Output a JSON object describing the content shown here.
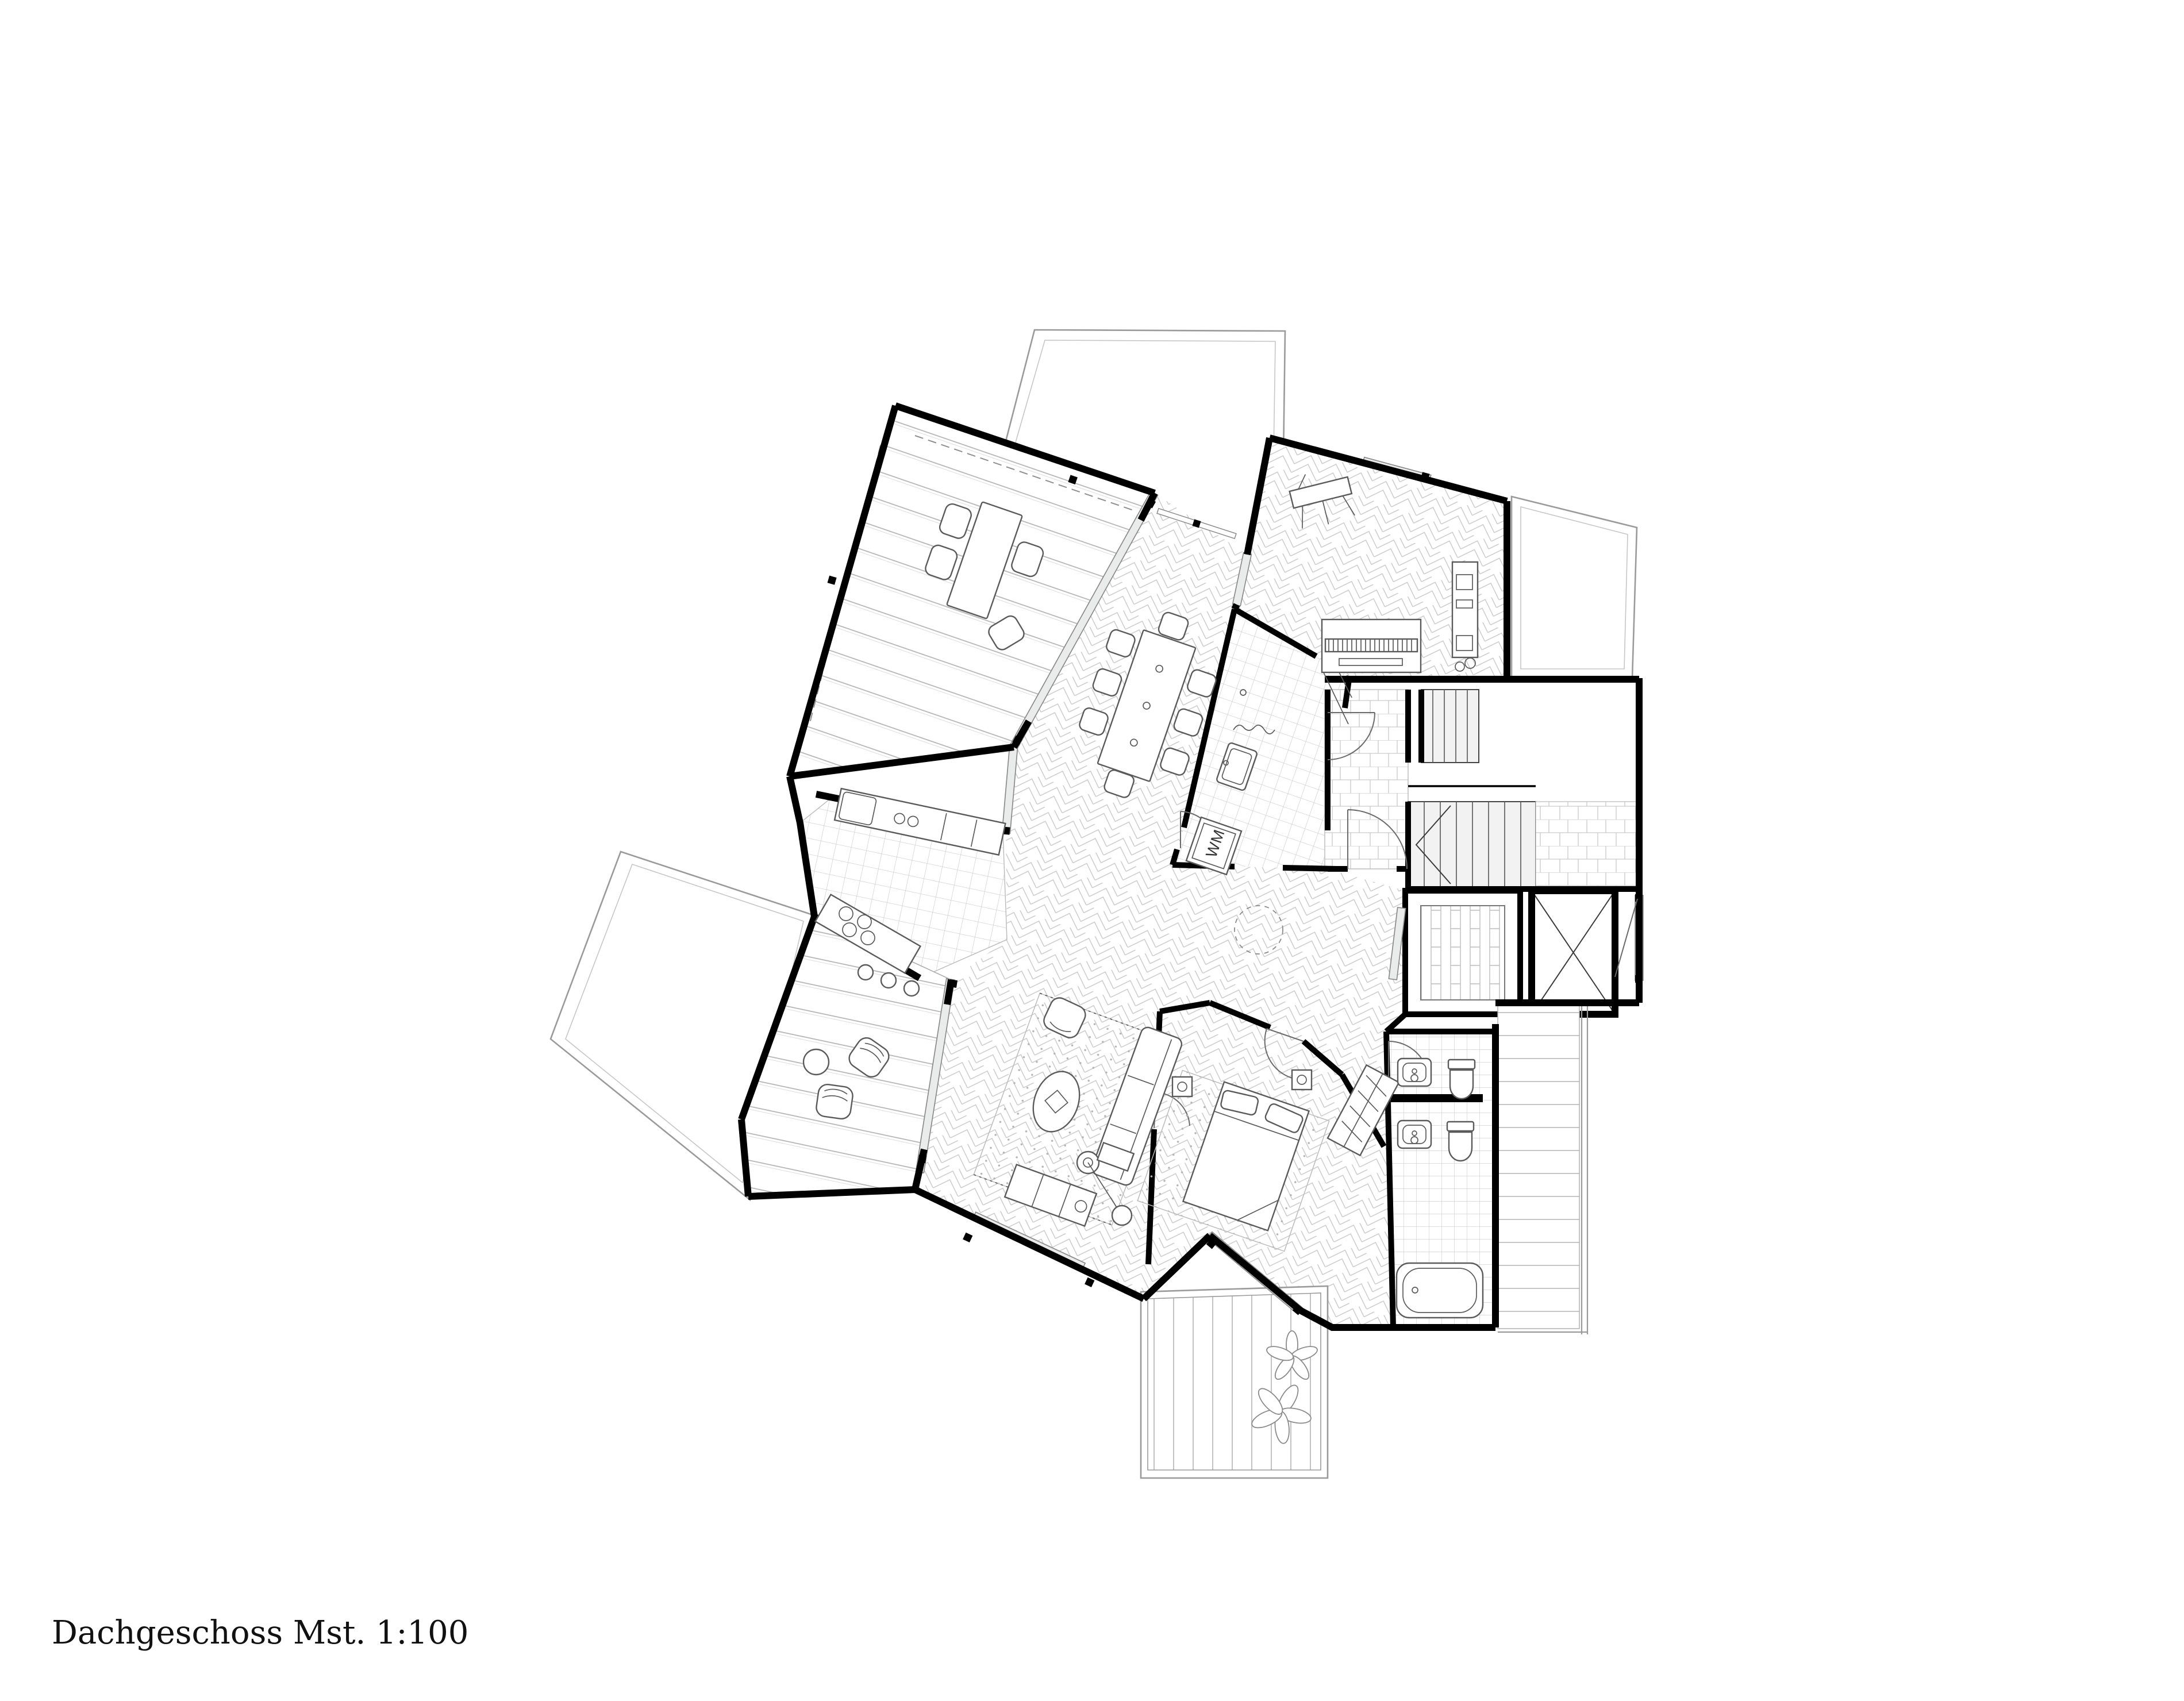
{
  "drawing": {
    "title": "Dachgeschoss Mst. 1:100",
    "floor_name": "Dachgeschoss",
    "scale": "Mst. 1:100",
    "type": "architectural floor plan, top view, black line work on white"
  },
  "labels": {
    "washing_machine": "WM"
  },
  "palette": {
    "background": "#ffffff",
    "walls": "#000000",
    "furniture_line": "#5a5a5a",
    "pattern_line": "#c9c9c9",
    "roof_outline": "#9a9a9a",
    "window_fill": "#e9eceb",
    "stair_fill": "#f2f2f2",
    "text": "#111111"
  },
  "symbols": [
    "upper-terrace-deck",
    "outdoor-dining-table",
    "outdoor-chairs",
    "dining-table-eight-chairs",
    "kitchen-counter",
    "cooktop-burners",
    "lower-terrace-deck",
    "lounge-chairs",
    "round-side-table",
    "living-rug",
    "sofa",
    "oval-coffee-table",
    "armchair",
    "arc-floor-lamp",
    "tv-lowboard",
    "double-bed",
    "nightstands",
    "wardrobe-with-hangers",
    "bathroom-two-sinks",
    "two-toilets",
    "bathtub",
    "utility-washing-machine",
    "utility-sink",
    "shower-curtain",
    "piano-with-keys",
    "media-sideboard",
    "drafting-easel",
    "stair-flights-with-treads",
    "elevator-cross",
    "sauna-cabin",
    "entrance-stone-floor",
    "door-swing-arcs",
    "dashed-skylight-circle",
    "south-balcony-plants",
    "east-balcony-deck",
    "roof-outlines"
  ]
}
